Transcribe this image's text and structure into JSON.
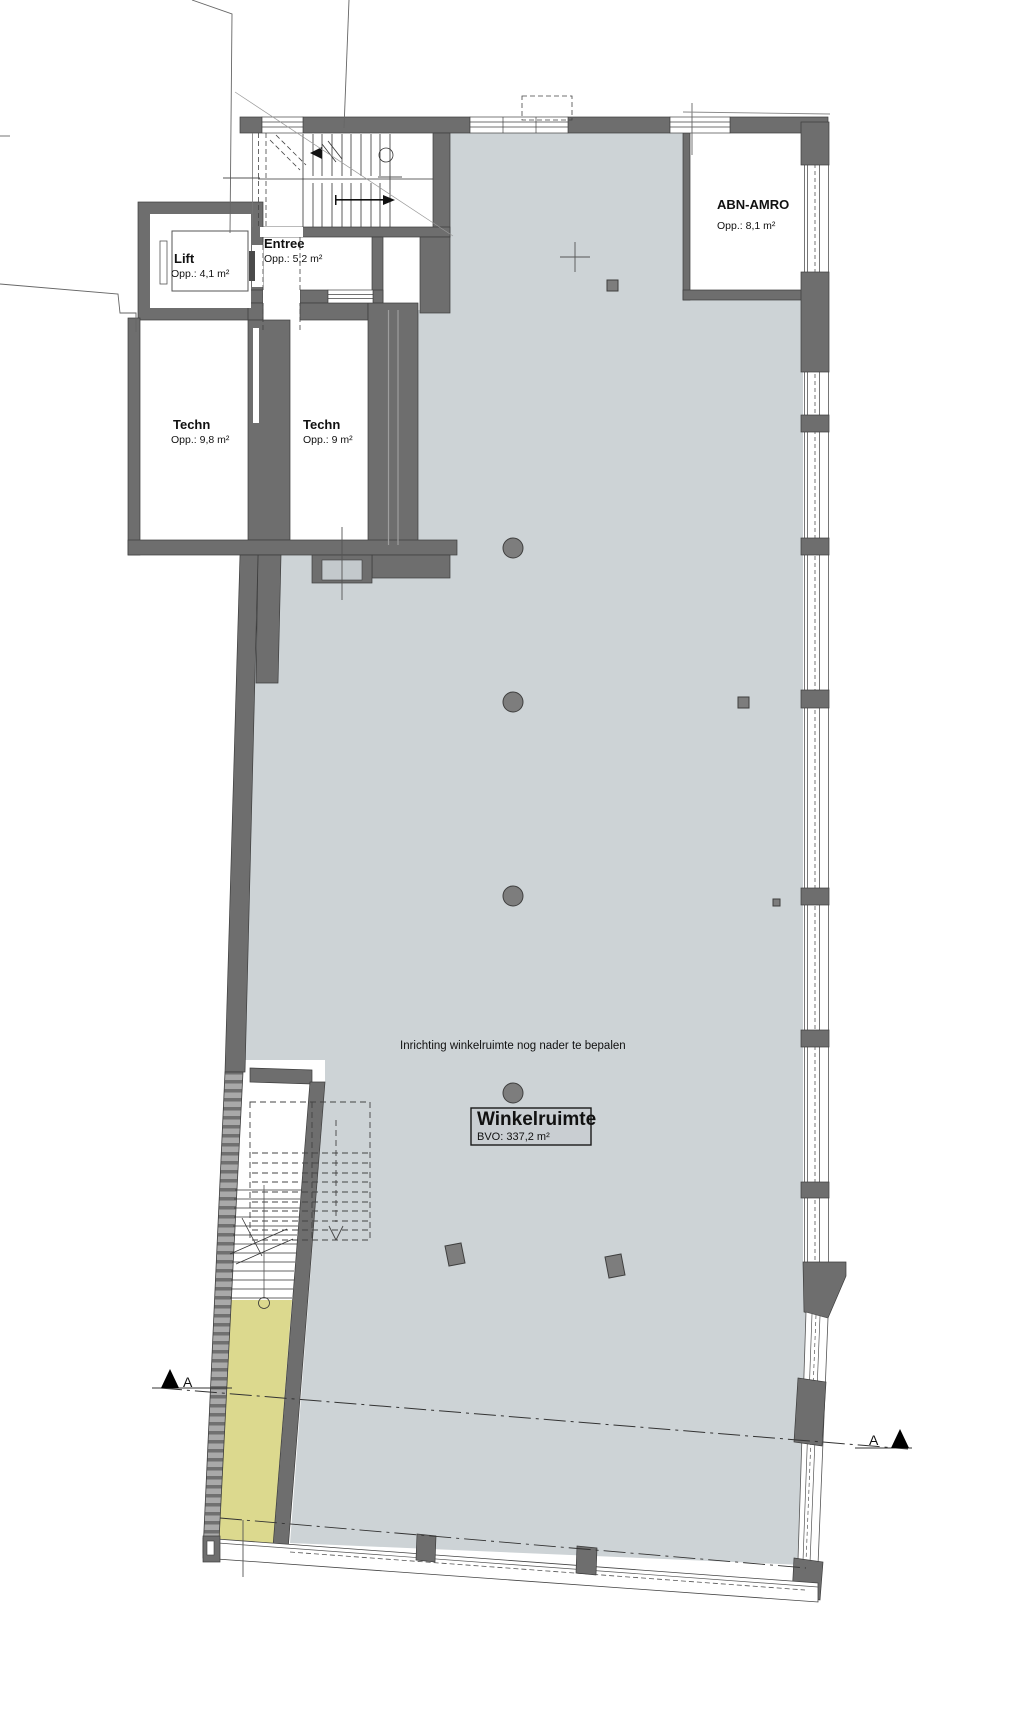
{
  "rooms": {
    "lift": {
      "name": "Lift",
      "area": "Opp.: 4,1 m²"
    },
    "entree": {
      "name": "Entree",
      "area": "Opp.: 5,2 m²"
    },
    "techn_links": {
      "name": "Techn",
      "area": "Opp.: 9,8 m²"
    },
    "techn_rechts": {
      "name": "Techn",
      "area": "Opp.: 9 m²"
    },
    "abn_amro": {
      "name": "ABN-AMRO",
      "area": "Opp.: 8,1 m²"
    },
    "winkelruimte": {
      "name": "Winkelruimte",
      "area": "BVO: 337,2 m²"
    }
  },
  "annotations": {
    "inrichting": "Inrichting winkelruimte nog nader te bepalen"
  },
  "section": {
    "left_label": "A",
    "right_label": "A"
  },
  "colors": {
    "floor": "#cdd3d6",
    "corridor": "#dcd98e",
    "wall": "#6e6e6e",
    "wall_outline": "#3d3d3d",
    "column": "#7d7d7d",
    "label_box_fill": "#c9ced2",
    "door_inset": "#c3c9cc"
  }
}
